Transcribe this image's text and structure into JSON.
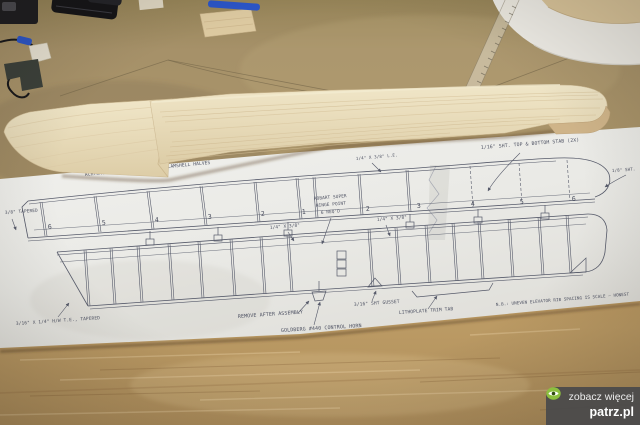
{
  "photo": {
    "colors": {
      "bench_top": "#a28e67",
      "bench_bottom": "#b5925c",
      "balsa_sheet": "#e7dab8",
      "plan_paper": "#ebebe7",
      "plan_ink": "#565a6a",
      "watermark_green": "#8cbf3f"
    }
  },
  "plan": {
    "note_top": "ACHTUNG! STAB IS BUILT IN 2 CLAMSHELL HALVES",
    "labels": {
      "le": "1/4\" X 3/8\" L.E.",
      "sheet": "1/16\" SHT. TOP & BOTTOM STAB (2X)",
      "taper": "3/8\" TAPERED",
      "hinge_1": "ROBART SUPER",
      "hinge_2": "HINGE POINT",
      "hinge_3": "6 REQ'D",
      "spar_left": "1/4\" X 3/8\"",
      "spar_right": "1/4\" X 3/8\"",
      "tip": "1/8\" SHT.",
      "te": "3/16\" X 1/4\" H/W T.E., TAPERED",
      "remove": "REMOVE AFTER ASSEMBLY",
      "horn": "GOLDBERG #440 CONTROL HORN",
      "gusset": "3/16\" SHT GUSSET",
      "trimtab": "LITHOPLATE TRIM TAB",
      "nb": "N.B.: UNEVEN ELEVATOR RIB SPACING IS SCALE — HONEST"
    },
    "ribs_left": [
      "6",
      "5",
      "4",
      "3",
      "2",
      "1"
    ],
    "ribs_right": [
      "2",
      "3",
      "4",
      "5",
      "6"
    ]
  },
  "watermark": {
    "line1": "zobacz więcej",
    "brand": "patrz.pl",
    "icon": "eye-icon"
  }
}
